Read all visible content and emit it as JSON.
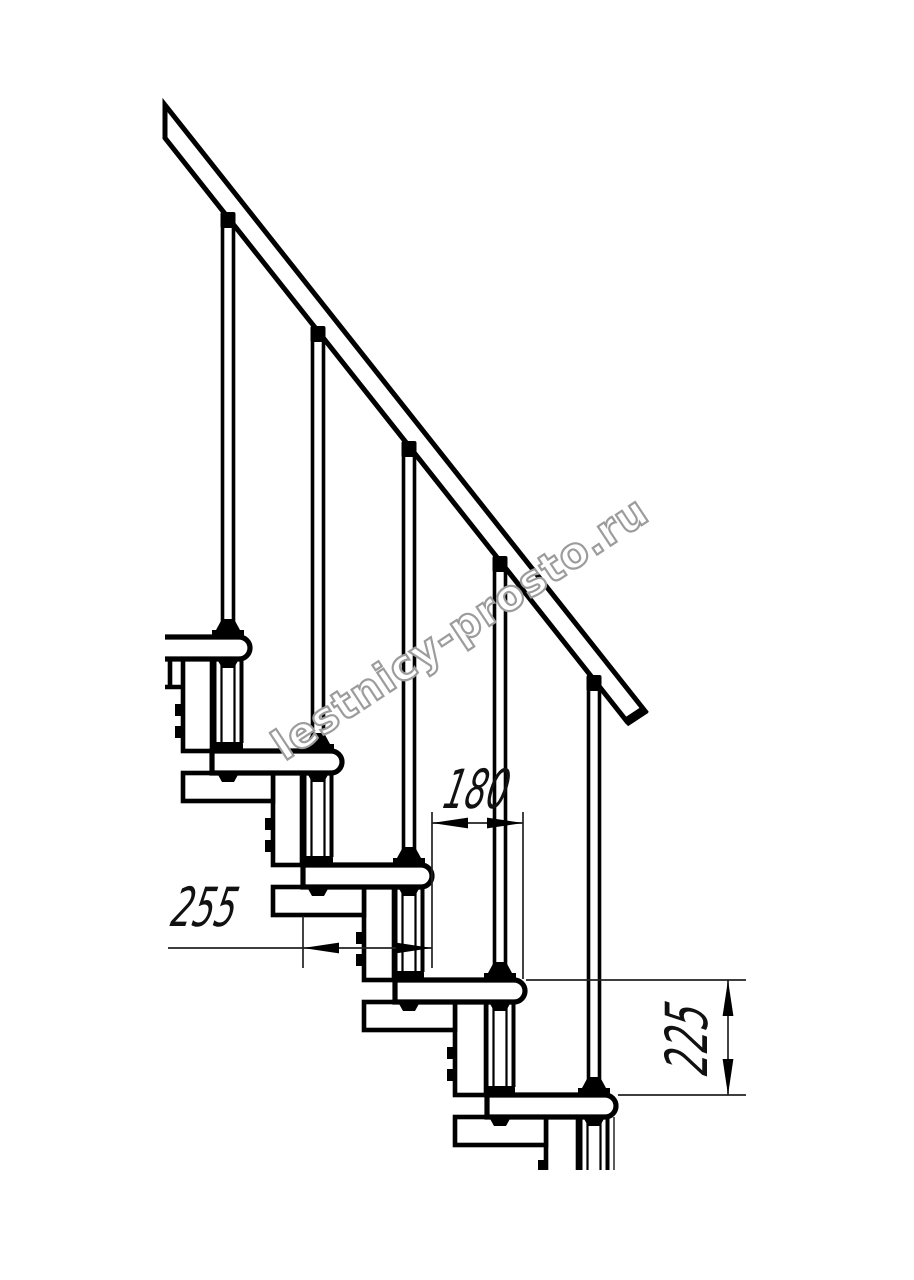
{
  "canvas": {
    "width": 914,
    "height": 1280,
    "background": "#ffffff",
    "ink": "#000000",
    "dim_color": "#111111"
  },
  "watermark": {
    "text": "lestnicy-prosto.ru",
    "color": "#9c9c9c"
  },
  "dimensions": {
    "run": {
      "value": "180",
      "orientation": "horizontal",
      "measures": "horizontal offset between tread nosings"
    },
    "depth": {
      "value": "255",
      "orientation": "horizontal",
      "measures": "tread depth"
    },
    "rise": {
      "value": "225",
      "orientation": "vertical",
      "measures": "step rise"
    }
  },
  "drawing": {
    "subject": "Modular staircase side section with handrail",
    "step_count": 5
  }
}
